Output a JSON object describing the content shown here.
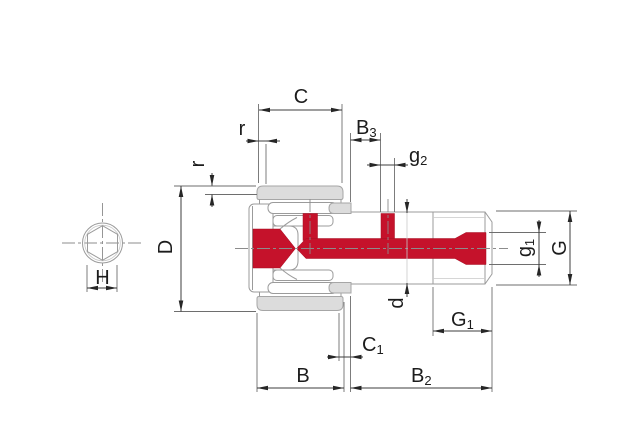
{
  "drawing": {
    "kind": "cam-follower-section-drawing",
    "colors": {
      "highlight_red": "#c5122b",
      "part_gray": "#dcdcdc",
      "outline_gray": "#9b9b9b",
      "dimension_dark": "#3d3d3d",
      "background": "#ffffff"
    },
    "dims": {
      "c": {
        "main": "C",
        "sub": ""
      },
      "r_top": {
        "main": "r",
        "sub": ""
      },
      "r_side": {
        "main": "r",
        "sub": ""
      },
      "b3": {
        "main": "B",
        "sub": "3"
      },
      "g2": {
        "main": "g",
        "sub": "2"
      },
      "d_outer": {
        "main": "D",
        "sub": ""
      },
      "d_stud": {
        "main": "d",
        "sub": ""
      },
      "g1": {
        "main": "g",
        "sub": "1"
      },
      "g_thread": {
        "main": "G",
        "sub": ""
      },
      "g1_len": {
        "main": "G",
        "sub": "1"
      },
      "c1": {
        "main": "C",
        "sub": "1"
      },
      "b": {
        "main": "B",
        "sub": ""
      },
      "b2": {
        "main": "B",
        "sub": "2"
      },
      "h": {
        "main": "H",
        "sub": ""
      }
    }
  }
}
